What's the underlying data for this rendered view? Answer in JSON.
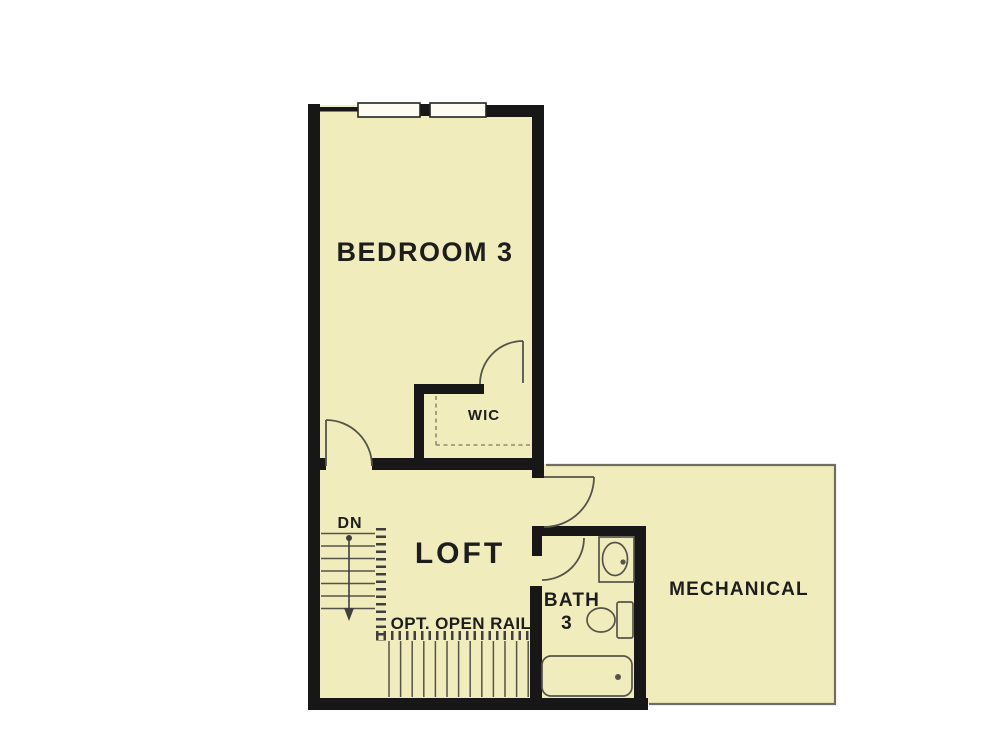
{
  "page": {
    "kind": "floor-plan",
    "background": "#ffffff"
  },
  "labels": {
    "bedroom3": "BEDROOM 3",
    "wic": "WIC",
    "loft": "LOFT",
    "bath_line1": "BATH",
    "bath_line2": "3",
    "mechanical": "MECHANICAL",
    "stair_direction": "DN",
    "rail_note": "OPT. OPEN RAIL"
  },
  "fixtures": [
    "double-window",
    "hinged-doors",
    "stairs-down",
    "open-rail",
    "closet-shelf-dashed",
    "sink",
    "toilet",
    "bathtub"
  ],
  "stairs": {
    "upper_tread_count": 7,
    "lower_tread_count": 13,
    "direction": "down"
  },
  "colors": {
    "room_fill": "#f1ecbb",
    "wall": "#171717",
    "line_mid": "#55544a",
    "dash": "#8e8c76",
    "text": "#1d1d1d",
    "window_fill": "#fdfcf2",
    "mech_border": "#6e6e64",
    "background": "#ffffff"
  }
}
